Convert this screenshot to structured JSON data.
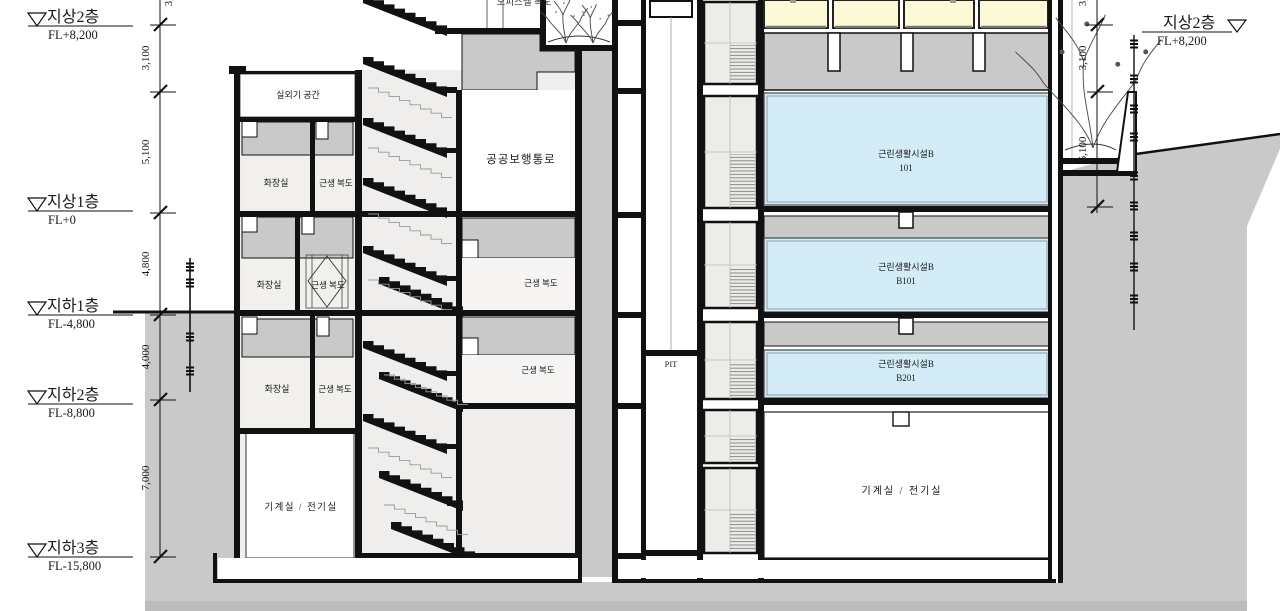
{
  "drawing": {
    "levels_left": [
      {
        "name": "지상2층",
        "elev": "FL+8,200"
      },
      {
        "name": "지상1층",
        "elev": "FL+0"
      },
      {
        "name": "지하1층",
        "elev": "FL-4,800"
      },
      {
        "name": "지하2층",
        "elev": "FL-8,800"
      },
      {
        "name": "지하3층",
        "elev": "FL-15,800"
      }
    ],
    "level_right": {
      "name": "지상2층",
      "elev": "FL+8,200"
    },
    "dims_left": [
      "3,100",
      "5,100",
      "4,800",
      "4,000",
      "7,000"
    ],
    "dims_right": [
      "3,100",
      "5,100"
    ],
    "dim_partial_top": "3,100",
    "rooms": {
      "outdoor_unit_space": "실외기 공간",
      "toilet": "화장실",
      "corridor": "근생 복도",
      "public_walkway": "공공보행통로",
      "officetel_corridor": "오피스텔 복도",
      "pit": "PIT",
      "facility_label": "근린생활시설B",
      "facility_units": [
        "101",
        "B101",
        "B201"
      ],
      "machine_room": "기계실 / 전기실"
    },
    "colors": {
      "facility_fill": "#d3ecf8",
      "upper_room_fill": "#fcfad6",
      "ground_fill": "#c9c9c9"
    }
  }
}
